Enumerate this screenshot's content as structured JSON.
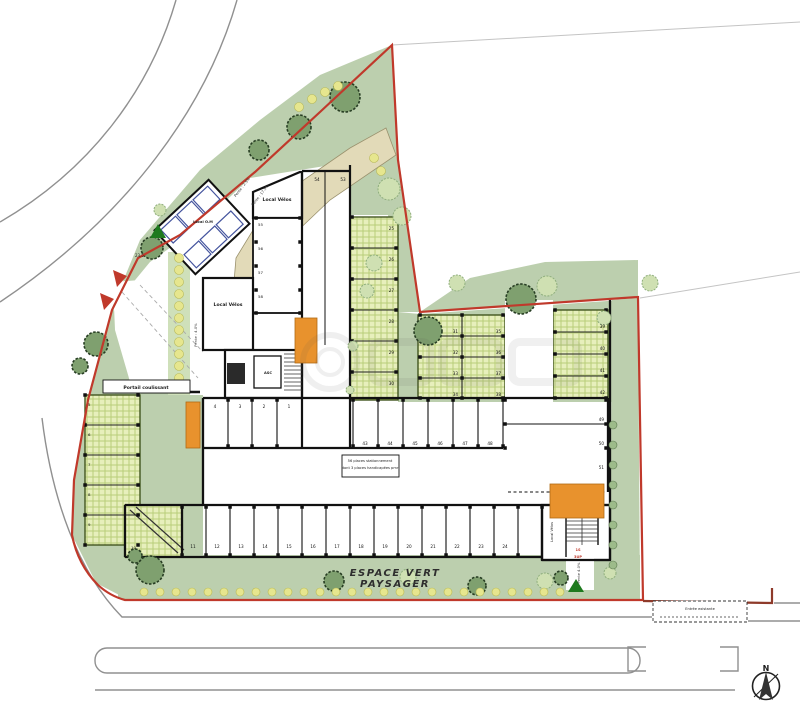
{
  "labels": {
    "local_om": "Local O.M",
    "local_velos": "Local Vélos",
    "asc": "ASC",
    "portail": "Portail coulissant",
    "espace1": "ESPACE VERT",
    "espace2": "PAYSAGER",
    "entree": "Entrée existante",
    "note1": "56 places stationnement",
    "note2": "dont 3 places handicapées pmr",
    "pente_a": "Pente : 2.5%",
    "pente_b": "Pente : 17.5%",
    "pente_c": "Pente : 4.0%",
    "pente_d": "Pente 4.0%",
    "stair1": "1S",
    "stair2": "3UP",
    "dim1": "23.5",
    "north": "N"
  },
  "spaces": {
    "top": [
      "54",
      "53"
    ],
    "upper_col": [
      "55",
      "56",
      "57",
      "58"
    ],
    "row1_left": [
      "4",
      "3",
      "2",
      "1"
    ],
    "row1_right": [
      "43",
      "44",
      "45",
      "46",
      "47",
      "48"
    ],
    "row1_end": [
      "49",
      "50",
      "51"
    ],
    "row2": [
      "11",
      "12",
      "13",
      "14",
      "15",
      "16",
      "17",
      "18",
      "19",
      "20",
      "21",
      "22",
      "23",
      "24"
    ],
    "left_col": [
      "5",
      "6",
      "7",
      "8",
      "9"
    ],
    "ramp": "10",
    "r1_col": [
      "25",
      "26",
      "27",
      "28",
      "29",
      "30"
    ],
    "mid_block": [
      "31",
      "32",
      "33",
      "34",
      "35",
      "36",
      "37",
      "38"
    ],
    "right_block": [
      "39",
      "40",
      "41",
      "42"
    ]
  },
  "colors": {
    "boundary_red": "#c0392b",
    "orange_access": "#e8922d",
    "landscape_green": "#bccfae",
    "paver_green": "#e7efbc",
    "tree_dark": "#7fa06f",
    "tree_light": "#cfe0b2",
    "shrub_yellow": "#e6e68e",
    "path_beige": "#e2dab8",
    "bin_blue": "#44549e"
  }
}
